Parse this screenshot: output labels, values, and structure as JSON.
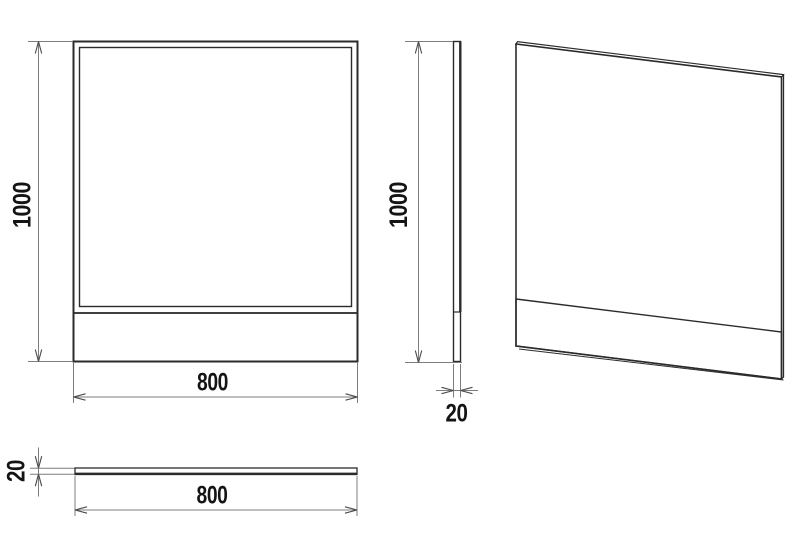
{
  "colors": {
    "background": "#ffffff",
    "object_line": "#2b2b2b",
    "dimension_line": "#7d7d7d",
    "arrow": "#4a4a4a",
    "text": "#141414"
  },
  "views": {
    "front": {
      "height_label": "1000",
      "width_label": "800"
    },
    "side": {
      "height_label": "1000",
      "thickness_label": "20"
    },
    "top": {
      "thickness_label": "20",
      "width_label": "800"
    }
  }
}
